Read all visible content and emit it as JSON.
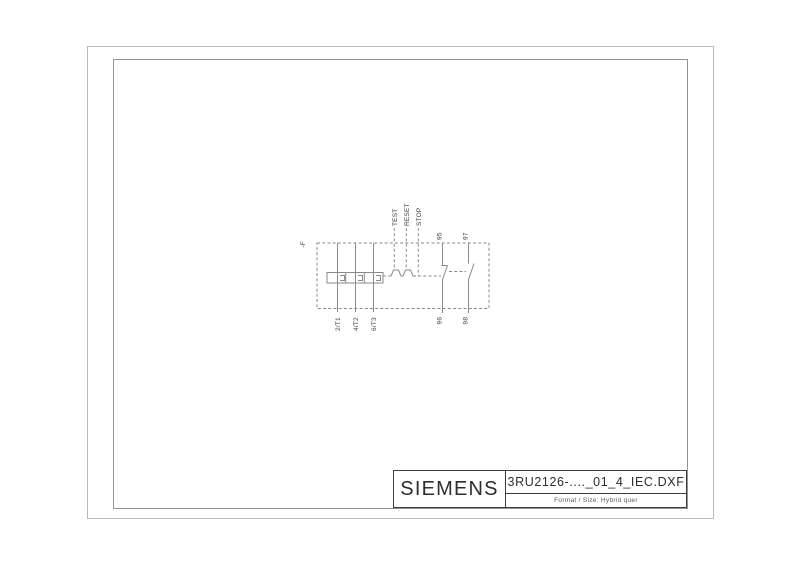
{
  "page": {
    "background": "#ffffff",
    "line_color": "#8a8a8a",
    "label_color": "#3a3a3a",
    "frame_outer_color": "#b9b9b9",
    "frame_inner_color": "#929292",
    "titleblock_border_color": "#3c3c3c"
  },
  "title_block": {
    "brand": "SIEMENS",
    "filename": "3RU2126-...._01_4_IEC.DXF",
    "format_label": "Format / Size: Hybrid quer"
  },
  "diagram": {
    "device_tag": "-F",
    "buttons": [
      "TEST",
      "RESET",
      "STOP"
    ],
    "terminals": {
      "phase": [
        "2/T1",
        "4/T2",
        "6/T3"
      ],
      "nc_top": "95",
      "nc_bottom": "96",
      "no_top": "97",
      "no_bottom": "98"
    }
  }
}
